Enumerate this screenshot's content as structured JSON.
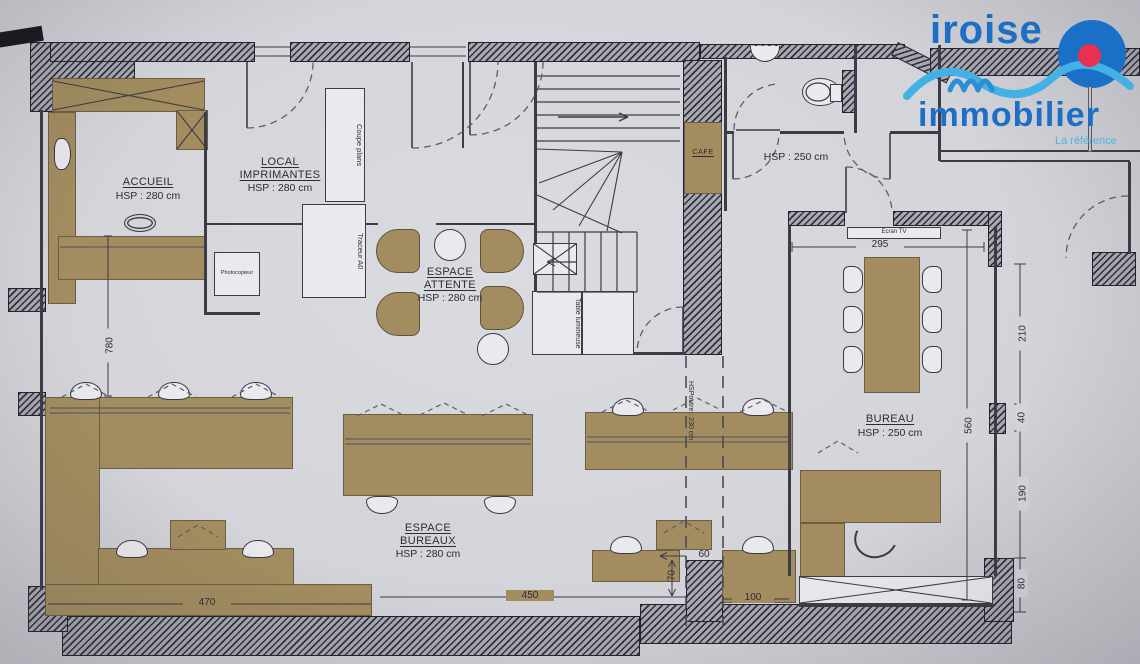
{
  "document": {
    "type": "floor-plan"
  },
  "logo": {
    "name": "iroise",
    "name2": "immobilier",
    "tagline": "La référence",
    "brand_blue": "#1c6fc4",
    "wave_blue": "#43b1e5",
    "dot_red": "#e8304f"
  },
  "rooms": {
    "accueil": {
      "name": "ACCUEIL",
      "height": "HSP : 280 cm"
    },
    "local_imprimantes": {
      "name": "LOCAL IMPRIMANTES",
      "height": "HSP : 280 cm"
    },
    "espace_attente": {
      "name": "ESPACE ATTENTE",
      "height": "HSP : 280 cm"
    },
    "espace_bureaux": {
      "name": "ESPACE BUREAUX",
      "height": "HSP : 280 cm"
    },
    "bureau": {
      "name": "BUREAU",
      "height": "HSP : 250 cm"
    },
    "sanitaires": {
      "height": "HSP : 250 cm"
    },
    "cafe": {
      "name": "CAFE"
    }
  },
  "equipment": {
    "photocopieur": "Photocopieur",
    "coupe_plans": "Coupe plans",
    "traceur_a0": "Traceur A0",
    "table_lumineuse": "Table lumineuse",
    "ecran_tv": "Ecran TV"
  },
  "annotations": {
    "beam_height": "HSPoutre : 230 cm"
  },
  "dimensions": {
    "hall_length": "780",
    "bureau_width": "295",
    "bureau_depth": "560",
    "right_1": "210",
    "right_2": "40",
    "right_3": "190",
    "right_4": "80",
    "bottom_left": "470",
    "bottom_center": "450",
    "bottom_right": "100",
    "recess_width": "60",
    "recess_depth": "70"
  }
}
